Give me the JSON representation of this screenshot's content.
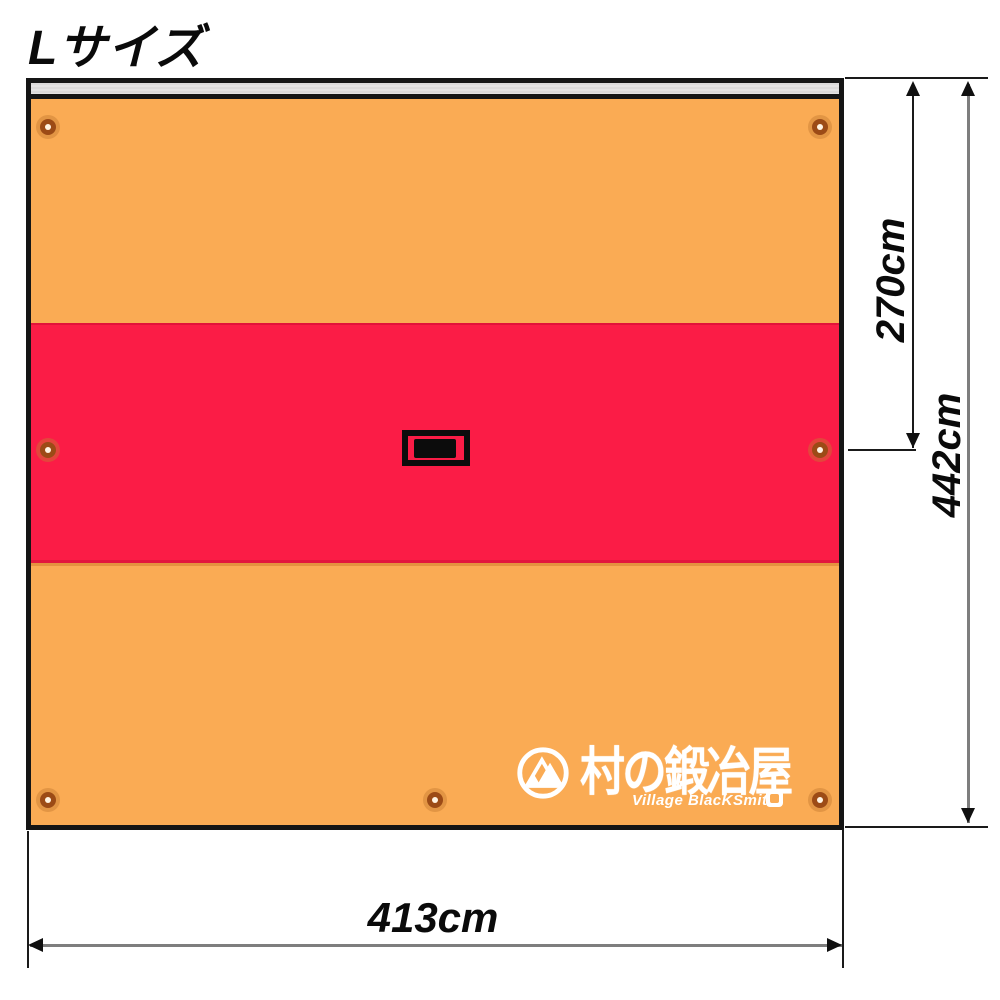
{
  "page": {
    "title": "Lサイズ"
  },
  "dimensions": {
    "width": "413cm",
    "total_height": "442cm",
    "upper_height": "270cm"
  },
  "logo": {
    "name_jp": "村の鍛冶屋",
    "name_en": "Village BlacKSmith"
  },
  "colors": {
    "orange": "#FAAB54",
    "red": "#FB1C46",
    "sleeve": "#E4E2E2",
    "tarp-border": "#151515",
    "dim-gray": "#7E7E7E",
    "dim-black": "#1A1A1A",
    "grommet-ring": "#9C4B16",
    "grommet-hole": "#FFF3E2",
    "logo-white": "#FFFFFF"
  }
}
